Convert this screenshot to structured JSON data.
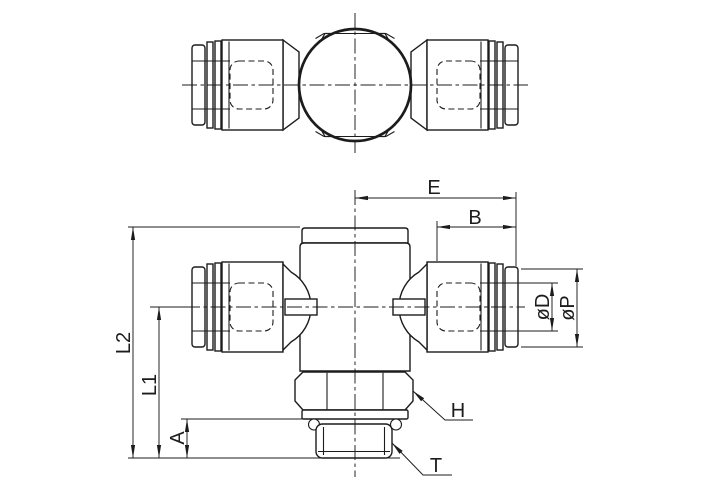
{
  "drawing": {
    "labels": {
      "e": "E",
      "b": "B",
      "diameter_d": "øD",
      "diameter_p": "øP",
      "l2": "L2",
      "l1": "L1",
      "a": "A",
      "h": "H",
      "t": "T"
    },
    "colors": {
      "line": "#1c1c1c",
      "background": "#ffffff"
    }
  }
}
